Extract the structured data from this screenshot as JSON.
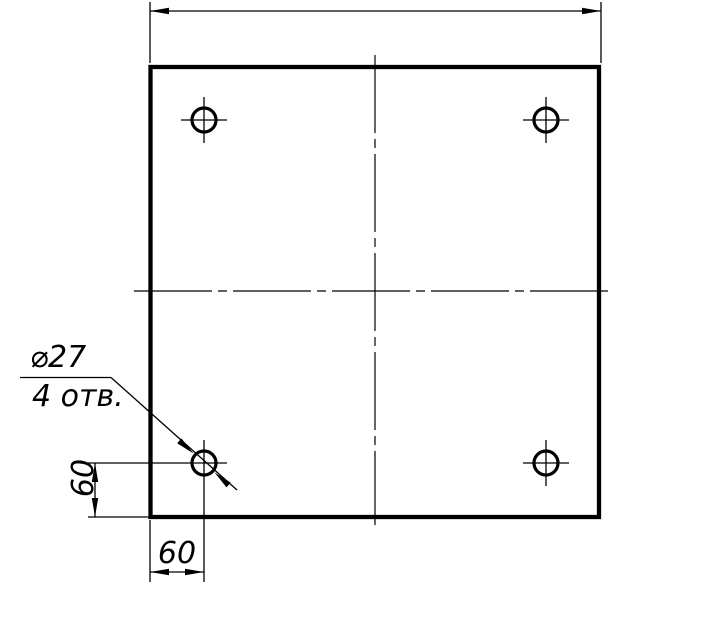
{
  "page": {
    "background_color": "#ffffff",
    "line_color": "#000000"
  },
  "drawing": {
    "view": "plate-top-view",
    "hole_callout": {
      "diameter_label": "⌀27",
      "count_label": "4 отв."
    },
    "dimensions": {
      "hole_offset_from_left_edge": "60",
      "hole_offset_from_bottom_edge": "60"
    }
  }
}
